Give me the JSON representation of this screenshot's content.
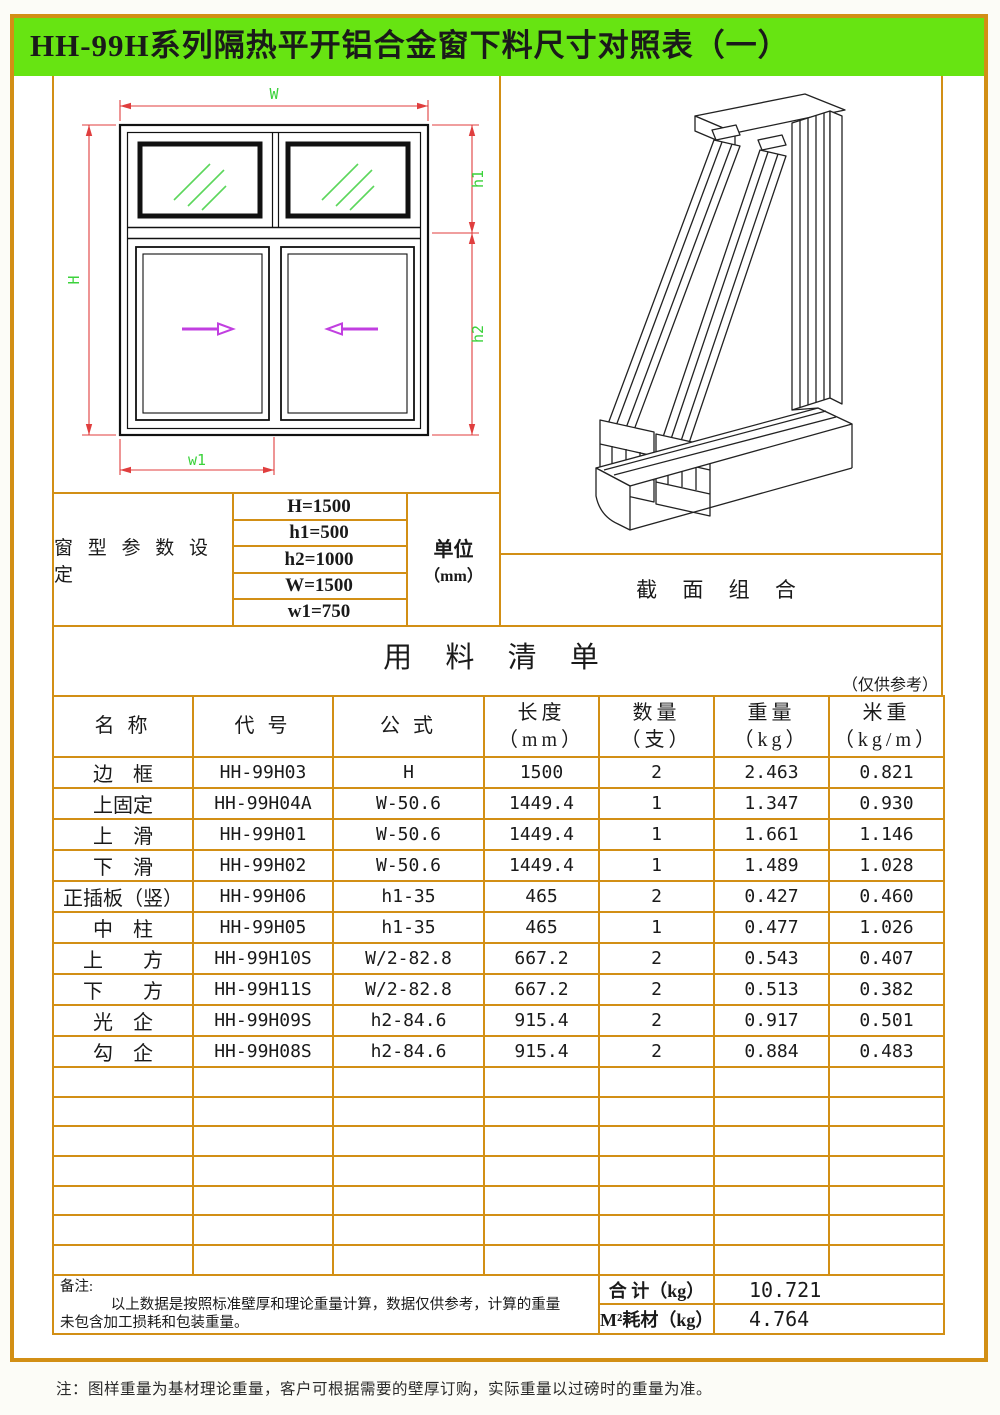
{
  "title": "HH-99H系列隔热平开铝合金窗下料尺寸对照表（一）",
  "colors": {
    "header_green": "#67e412",
    "frame_orange": "#d28f15",
    "dimension_red": "#e03e3e",
    "dimension_label_green": "#3bd23b",
    "arrow_magenta": "#c13fe0"
  },
  "diagram": {
    "labels": {
      "W": "W",
      "H": "H",
      "h1": "h1",
      "h2": "h2",
      "w1": "w1"
    }
  },
  "section_label": "截 面 组 合",
  "parameters": {
    "group_label": "窗 型 参 数 设 定",
    "rows": [
      "H=1500",
      "h1=500",
      "h2=1000",
      "W=1500",
      "w1=750"
    ],
    "unit_label": "单位",
    "unit_sub": "（mm）"
  },
  "materials": {
    "title": "用 料 清 单",
    "ref_note": "（仅供参考）",
    "headers": [
      [
        "名 称"
      ],
      [
        "代 号"
      ],
      [
        "公 式"
      ],
      [
        "长度",
        "（mm）"
      ],
      [
        "数量",
        "（支）"
      ],
      [
        "重量",
        "（kg）"
      ],
      [
        "米重",
        "（kg/m）"
      ]
    ],
    "rows": [
      [
        "边　框",
        "HH-99H03",
        "H",
        "1500",
        "2",
        "2.463",
        "0.821"
      ],
      [
        "上固定",
        "HH-99H04A",
        "W-50.6",
        "1449.4",
        "1",
        "1.347",
        "0.930"
      ],
      [
        "上　滑",
        "HH-99H01",
        "W-50.6",
        "1449.4",
        "1",
        "1.661",
        "1.146"
      ],
      [
        "下　滑",
        "HH-99H02",
        "W-50.6",
        "1449.4",
        "1",
        "1.489",
        "1.028"
      ],
      [
        "正插板（竖）",
        "HH-99H06",
        "h1-35",
        "465",
        "2",
        "0.427",
        "0.460"
      ],
      [
        "中　柱",
        "HH-99H05",
        "h1-35",
        "465",
        "1",
        "0.477",
        "1.026"
      ],
      [
        "上　　方",
        "HH-99H10S",
        "W/2-82.8",
        "667.2",
        "2",
        "0.543",
        "0.407"
      ],
      [
        "下　　方",
        "HH-99H11S",
        "W/2-82.8",
        "667.2",
        "2",
        "0.513",
        "0.382"
      ],
      [
        "光　企",
        "HH-99H09S",
        "h2-84.6",
        "915.4",
        "2",
        "0.917",
        "0.501"
      ],
      [
        "勾　企",
        "HH-99H08S",
        "h2-84.6",
        "915.4",
        "2",
        "0.884",
        "0.483"
      ]
    ],
    "empty_row_count": 7
  },
  "footer": {
    "remark_label": "备注:",
    "remark_line1": "以上数据是按照标准壁厚和理论重量计算，数据仅供参考，计算的重量",
    "remark_line2": "未包含加工损耗和包装重量。",
    "total_label": "合 计（kg）",
    "total_value": "10.721",
    "per_label": "M²耗材（kg）",
    "per_value": "4.764"
  },
  "bottom_note": "注：图样重量为基材理论重量，客户可根据需要的壁厚订购，实际重量以过磅时的重量为准。"
}
